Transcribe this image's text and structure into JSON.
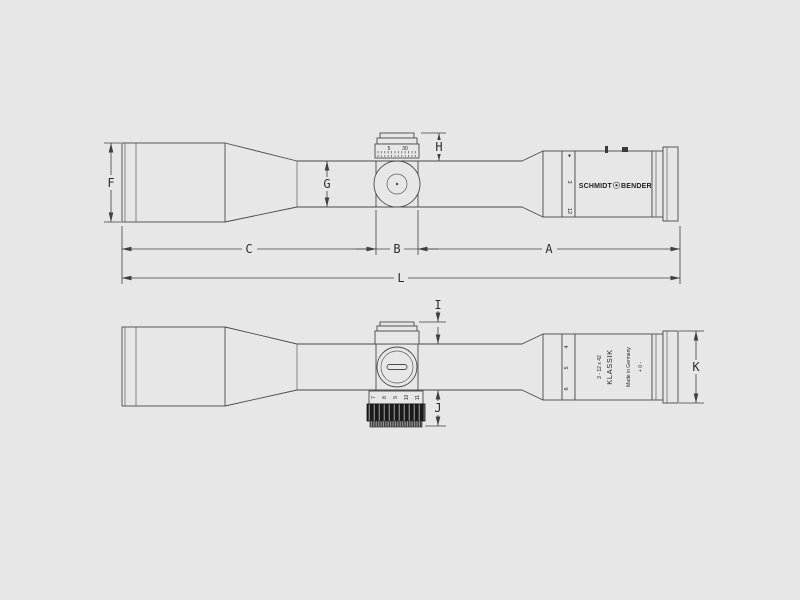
{
  "colors": {
    "background": "#e7e7e7",
    "outline": "#4a4a4a",
    "dimension": "#3f3f3f",
    "dark_band": "#1a1a1a"
  },
  "dims": {
    "a": "A",
    "b": "B",
    "c": "C",
    "f": "F",
    "g": "G",
    "h": "H",
    "i": "I",
    "j": "J",
    "k": "K",
    "l": "L"
  },
  "scope": {
    "brand_left": "SCHMIDT",
    "brand_right": "BENDER",
    "magnification": "3 - 12 x 42",
    "series": "KLASSIK",
    "origin": "Made in Germany",
    "diopter": "+ 0 -",
    "turret_scale": [
      "5",
      "30"
    ],
    "mag_ring_top": [
      "▸",
      "3",
      "12"
    ],
    "mag_ring_bottom": [
      "4",
      "5",
      "6"
    ],
    "parallax_numbers": [
      "7",
      "8",
      "9",
      "10",
      "11"
    ]
  }
}
